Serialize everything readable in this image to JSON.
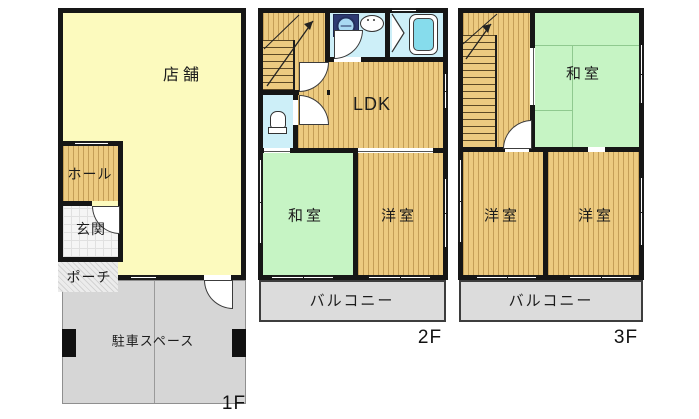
{
  "title": "3-story floor plan",
  "floor1": {
    "tag": "1F",
    "rooms": {
      "shop": "店舗",
      "hall": "ホール",
      "genkan": "玄関",
      "porch": "ポーチ",
      "parking": "駐車スペース"
    }
  },
  "floor2": {
    "tag": "2F",
    "rooms": {
      "ldk": "LDK",
      "washitsu": "和室",
      "youshitsu": "洋室",
      "balcony": "バルコニー"
    }
  },
  "floor3": {
    "tag": "3F",
    "rooms": {
      "washitsu": "和室",
      "youshitsu_left": "洋室",
      "youshitsu_right": "洋室",
      "balcony": "バルコニー"
    }
  },
  "icons": {
    "washing_machine": "washing-machine-icon",
    "sink": "sink-icon",
    "bathtub": "bathtub-icon",
    "toilet": "toilet-icon",
    "stairs_arrow": "stairs-up-arrow-icon",
    "folding_door": "bath-folding-door-icon"
  },
  "colors": {
    "wall": "#161616",
    "shop_yellow": "#FCFABE",
    "wood_floor": "#ECCA80",
    "tatami_green": "#C6F4C4",
    "water_blue": "#CDEFF8",
    "bathtub_cyan": "#86DCEC",
    "balcony_gray": "#DCDCDC",
    "parking_gray": "#D6D6D6"
  }
}
